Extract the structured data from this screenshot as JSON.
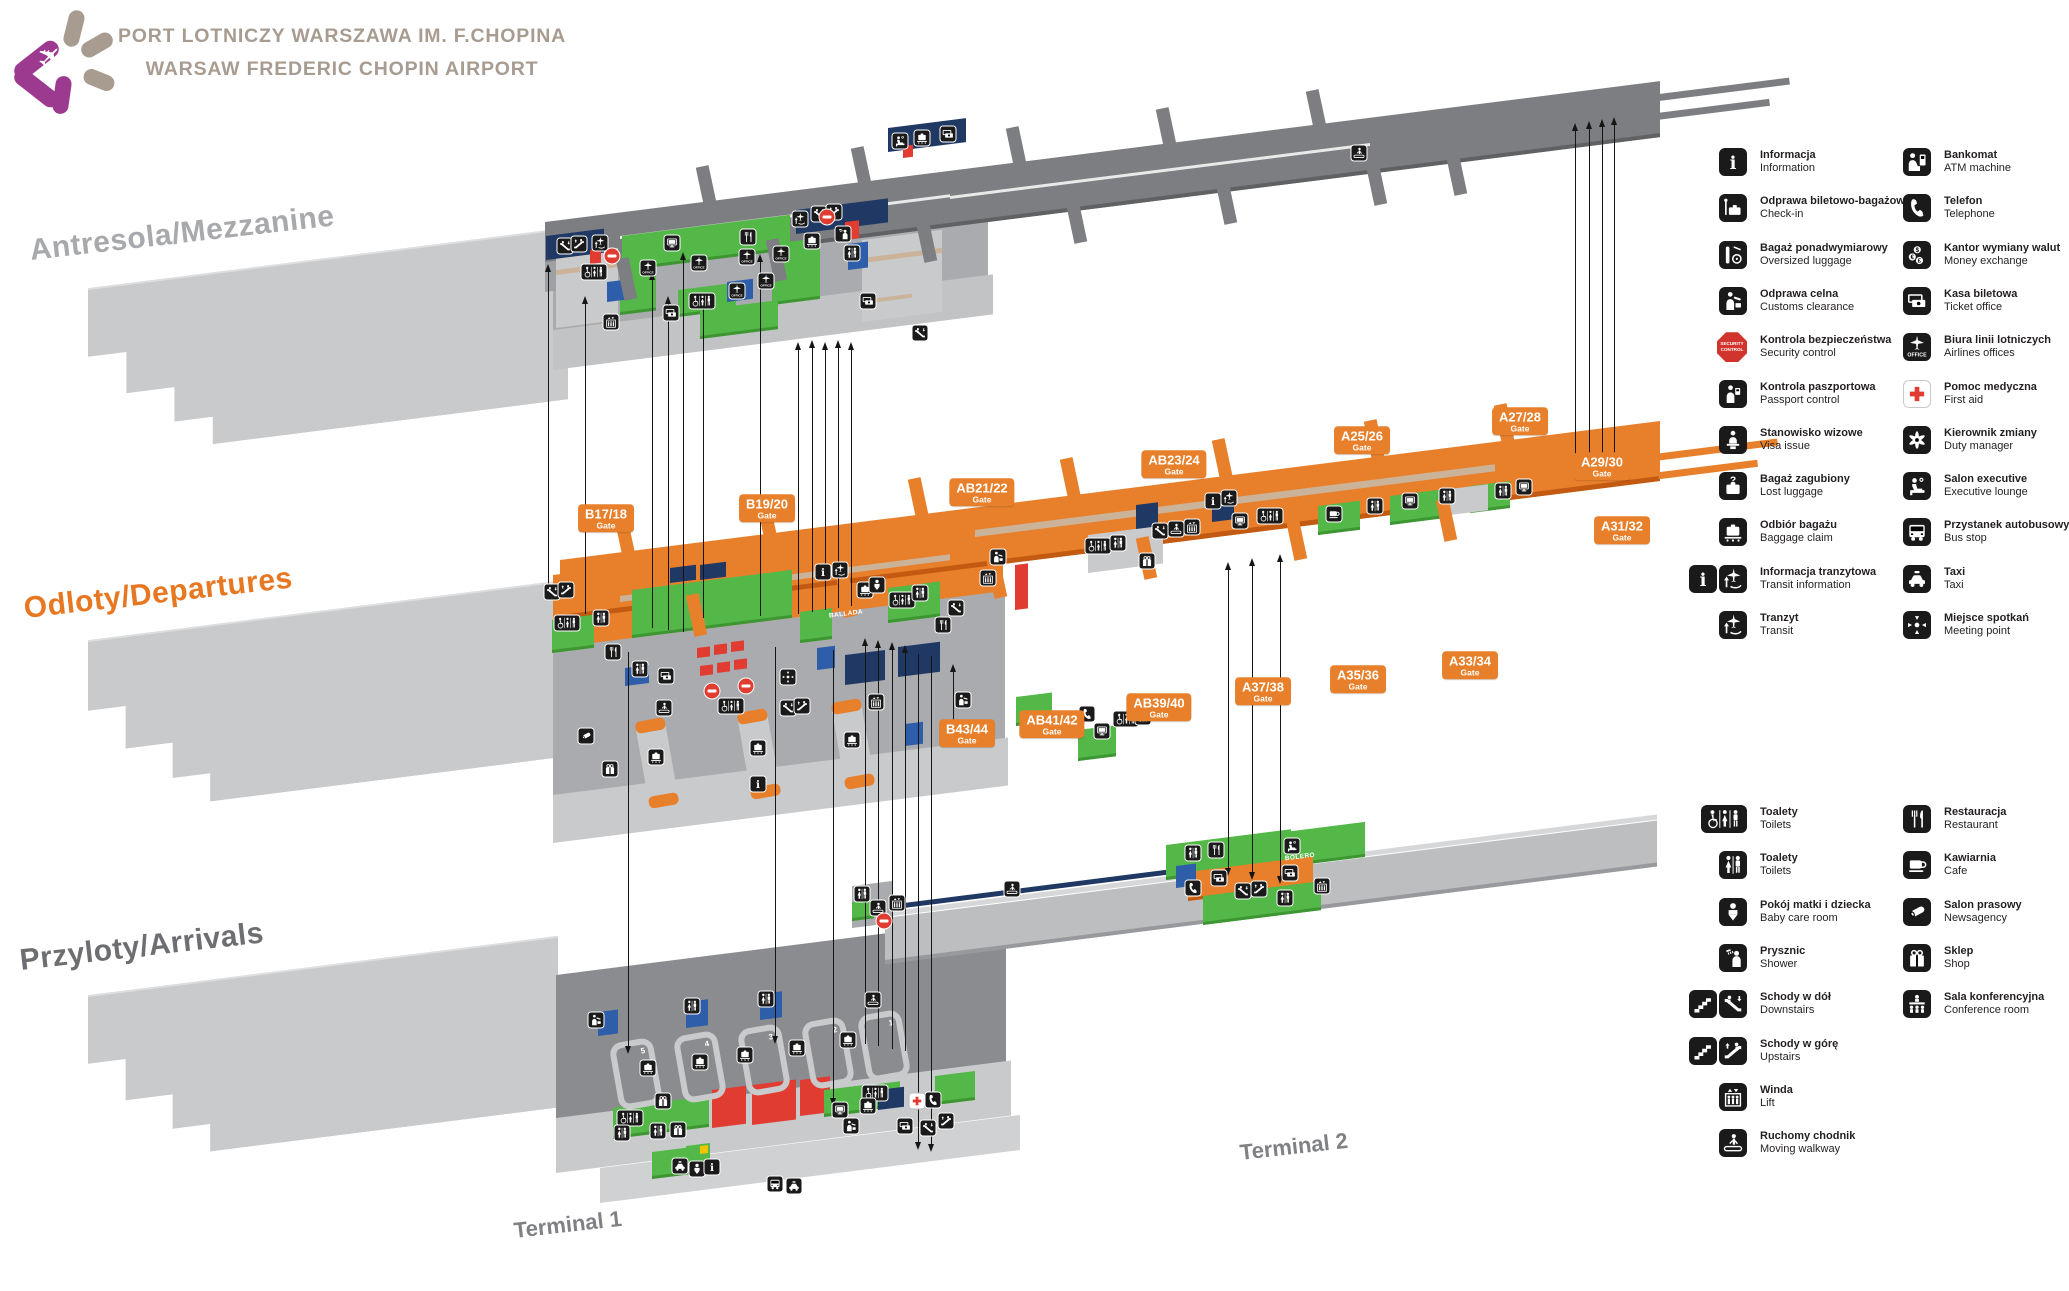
{
  "header": {
    "title_pl": "PORT LOTNICZY WARSZAWA IM. F.CHOPINA",
    "title_en": "WARSAW FREDERIC CHOPIN AIRPORT"
  },
  "levels": [
    {
      "id": "mezzanine",
      "label": "Antresola/Mezzanine"
    },
    {
      "id": "departures",
      "label": "Odloty/Departures"
    },
    {
      "id": "arrivals",
      "label": "Przyloty/Arrivals"
    }
  ],
  "terminals": [
    {
      "label": "Terminal 1"
    },
    {
      "label": "Terminal 2"
    }
  ],
  "area_labels": [
    {
      "text": "BALLADA",
      "x": 846,
      "y": 614
    },
    {
      "text": "BOLERO",
      "x": 1300,
      "y": 857
    }
  ],
  "carousels": [
    "5",
    "4",
    "3",
    "2",
    "1"
  ],
  "gates": {
    "sublabel": "Gate",
    "items": [
      {
        "label": "B17/18",
        "x": 606,
        "y": 518
      },
      {
        "label": "B19/20",
        "x": 767,
        "y": 508
      },
      {
        "label": "AB21/22",
        "x": 982,
        "y": 492
      },
      {
        "label": "AB23/24",
        "x": 1174,
        "y": 464
      },
      {
        "label": "A25/26",
        "x": 1362,
        "y": 440
      },
      {
        "label": "A27/28",
        "x": 1520,
        "y": 421
      },
      {
        "label": "A29/30",
        "x": 1602,
        "y": 466
      },
      {
        "label": "A31/32",
        "x": 1622,
        "y": 530
      },
      {
        "label": "A33/34",
        "x": 1470,
        "y": 665
      },
      {
        "label": "A35/36",
        "x": 1358,
        "y": 679
      },
      {
        "label": "A37/38",
        "x": 1263,
        "y": 691
      },
      {
        "label": "AB39/40",
        "x": 1159,
        "y": 707
      },
      {
        "label": "AB41/42",
        "x": 1052,
        "y": 724
      },
      {
        "label": "B43/44",
        "x": 967,
        "y": 733
      }
    ]
  },
  "legend": {
    "groups": [
      {
        "columns": [
          [
            {
              "pl": "Informacja",
              "en": "Information",
              "icons": [
                "info"
              ]
            },
            {
              "pl": "Odprawa biletowo-bagażowa",
              "en": "Check-in",
              "icons": [
                "checkin"
              ]
            },
            {
              "pl": "Bagaż ponadwymiarowy",
              "en": "Oversized luggage",
              "icons": [
                "oversized"
              ]
            },
            {
              "pl": "Odprawa celna",
              "en": "Customs clearance",
              "icons": [
                "customs"
              ]
            },
            {
              "pl": "Kontrola bezpieczeństwa",
              "en": "Security control",
              "icons": [
                "security"
              ],
              "icon_text": "SECURITY CONTROL"
            },
            {
              "pl": "Kontrola paszportowa",
              "en": "Passport control",
              "icons": [
                "passport"
              ]
            },
            {
              "pl": "Stanowisko wizowe",
              "en": "Visa issue",
              "icons": [
                "visa"
              ]
            },
            {
              "pl": "Bagaż zagubiony",
              "en": "Lost luggage",
              "icons": [
                "lost"
              ]
            },
            {
              "pl": "Odbiór bagażu",
              "en": "Baggage claim",
              "icons": [
                "claim"
              ]
            },
            {
              "pl": "Informacja tranzytowa",
              "en": "Transit information",
              "icons": [
                "info",
                "transit"
              ]
            },
            {
              "pl": "Tranzyt",
              "en": "Transit",
              "icons": [
                "transit"
              ]
            }
          ],
          [
            {
              "pl": "Bankomat",
              "en": "ATM machine",
              "icons": [
                "atm"
              ]
            },
            {
              "pl": "Telefon",
              "en": "Telephone",
              "icons": [
                "phone"
              ]
            },
            {
              "pl": "Kantor wymiany walut",
              "en": "Money exchange",
              "icons": [
                "exchange"
              ]
            },
            {
              "pl": "Kasa biletowa",
              "en": "Ticket office",
              "icons": [
                "ticket"
              ]
            },
            {
              "pl": "Biura linii lotniczych",
              "en": "Airlines offices",
              "icons": [
                "office"
              ]
            },
            {
              "pl": "Pomoc medyczna",
              "en": "First aid",
              "icons": [
                "firstaid"
              ]
            },
            {
              "pl": "Kierownik zmiany",
              "en": "Duty manager",
              "icons": [
                "duty"
              ]
            },
            {
              "pl": "Salon executive",
              "en": "Executive lounge",
              "icons": [
                "lounge"
              ]
            },
            {
              "pl": "Przystanek autobusowy",
              "en": "Bus stop",
              "icons": [
                "bus"
              ]
            },
            {
              "pl": "Taxi",
              "en": "Taxi",
              "icons": [
                "taxi"
              ]
            },
            {
              "pl": "Miejsce spotkań",
              "en": "Meeting point",
              "icons": [
                "meeting"
              ]
            }
          ]
        ]
      },
      {
        "columns": [
          [
            {
              "pl": "Toalety",
              "en": "Toilets",
              "icons": [
                "toilets-acc"
              ]
            },
            {
              "pl": "Toalety",
              "en": "Toilets",
              "icons": [
                "toilets"
              ]
            },
            {
              "pl": "Pokój matki i dziecka",
              "en": "Baby care room",
              "icons": [
                "baby"
              ]
            },
            {
              "pl": "Prysznic",
              "en": "Shower",
              "icons": [
                "shower"
              ]
            },
            {
              "pl": "Schody w dół",
              "en": "Downstairs",
              "icons": [
                "stairs",
                "esc-down"
              ]
            },
            {
              "pl": "Schody w górę",
              "en": "Upstairs",
              "icons": [
                "stairs",
                "esc-up"
              ]
            },
            {
              "pl": "Winda",
              "en": "Lift",
              "icons": [
                "lift"
              ]
            },
            {
              "pl": "Ruchomy chodnik",
              "en": "Moving walkway",
              "icons": [
                "walkway"
              ]
            }
          ],
          [
            {
              "pl": "Restauracja",
              "en": "Restaurant",
              "icons": [
                "restaurant"
              ]
            },
            {
              "pl": "Kawiarnia",
              "en": "Cafe",
              "icons": [
                "cafe"
              ]
            },
            {
              "pl": "Salon prasowy",
              "en": "Newsagency",
              "icons": [
                "news"
              ]
            },
            {
              "pl": "Sklep",
              "en": "Shop",
              "icons": [
                "shop"
              ]
            },
            {
              "pl": "Sala konferencyjna",
              "en": "Conference room",
              "icons": [
                "conference"
              ]
            }
          ]
        ]
      }
    ]
  },
  "map_icons": [
    [
      565,
      246,
      "esc-down"
    ],
    [
      579,
      244,
      "esc-up"
    ],
    [
      600,
      243,
      "transit"
    ],
    [
      612,
      256,
      "stop"
    ],
    [
      594,
      272,
      "toilets-acc"
    ],
    [
      672,
      243,
      "screen"
    ],
    [
      748,
      237,
      "restaurant"
    ],
    [
      648,
      268,
      "office"
    ],
    [
      699,
      263,
      "office"
    ],
    [
      747,
      257,
      "office"
    ],
    [
      781,
      254,
      "office"
    ],
    [
      737,
      291,
      "office"
    ],
    [
      766,
      281,
      "office"
    ],
    [
      702,
      301,
      "toilets-acc"
    ],
    [
      671,
      313,
      "ticket"
    ],
    [
      611,
      322,
      "lift"
    ],
    [
      800,
      219,
      "transit"
    ],
    [
      819,
      214,
      "esc-down"
    ],
    [
      834,
      212,
      "esc-up"
    ],
    [
      827,
      217,
      "stop"
    ],
    [
      812,
      241,
      "claim"
    ],
    [
      843,
      234,
      "shower"
    ],
    [
      852,
      253,
      "toilets"
    ],
    [
      868,
      301,
      "ticket"
    ],
    [
      920,
      333,
      "esc-down"
    ],
    [
      900,
      141,
      "lounge"
    ],
    [
      922,
      138,
      "claim"
    ],
    [
      948,
      134,
      "ticket"
    ],
    [
      1359,
      153,
      "walkway"
    ],
    [
      552,
      592,
      "esc-down"
    ],
    [
      566,
      590,
      "esc-up"
    ],
    [
      567,
      623,
      "toilets-acc"
    ],
    [
      601,
      618,
      "toilets"
    ],
    [
      613,
      652,
      "restaurant"
    ],
    [
      640,
      669,
      "toilets"
    ],
    [
      666,
      676,
      "ticket"
    ],
    [
      712,
      691,
      "stop"
    ],
    [
      746,
      686,
      "stop"
    ],
    [
      731,
      706,
      "toilets-acc"
    ],
    [
      788,
      708,
      "esc-down"
    ],
    [
      802,
      706,
      "esc-up"
    ],
    [
      823,
      572,
      "info"
    ],
    [
      840,
      570,
      "transit"
    ],
    [
      865,
      590,
      "claim"
    ],
    [
      877,
      585,
      "baby"
    ],
    [
      902,
      600,
      "toilets-acc"
    ],
    [
      920,
      593,
      "toilets"
    ],
    [
      943,
      625,
      "restaurant"
    ],
    [
      956,
      608,
      "esc-down"
    ],
    [
      656,
      757,
      "claim"
    ],
    [
      758,
      748,
      "claim"
    ],
    [
      852,
      740,
      "claim"
    ],
    [
      758,
      784,
      "info"
    ],
    [
      586,
      736,
      "news"
    ],
    [
      610,
      769,
      "shop"
    ],
    [
      664,
      708,
      "walkway"
    ],
    [
      876,
      702,
      "lift"
    ],
    [
      788,
      677,
      "meeting"
    ],
    [
      963,
      700,
      "customs"
    ],
    [
      1048,
      727,
      "lounge"
    ],
    [
      1087,
      714,
      "phone"
    ],
    [
      1102,
      731,
      "screen"
    ],
    [
      1126,
      719,
      "toilets-acc"
    ],
    [
      1143,
      717,
      "toilets"
    ],
    [
      998,
      557,
      "customs"
    ],
    [
      988,
      578,
      "lift"
    ],
    [
      1098,
      546,
      "toilets-acc"
    ],
    [
      1118,
      543,
      "toilets"
    ],
    [
      1147,
      561,
      "shop"
    ],
    [
      1160,
      531,
      "esc-down"
    ],
    [
      1176,
      529,
      "walkway"
    ],
    [
      1192,
      527,
      "lift"
    ],
    [
      1213,
      501,
      "info"
    ],
    [
      1229,
      498,
      "transit"
    ],
    [
      1240,
      521,
      "screen"
    ],
    [
      1270,
      516,
      "toilets-acc"
    ],
    [
      1334,
      514,
      "cafe"
    ],
    [
      1375,
      506,
      "toilets"
    ],
    [
      1410,
      501,
      "screen"
    ],
    [
      1447,
      496,
      "toilets"
    ],
    [
      1503,
      491,
      "toilets"
    ],
    [
      1524,
      487,
      "screen"
    ],
    [
      596,
      1020,
      "customs"
    ],
    [
      692,
      1006,
      "toilets"
    ],
    [
      766,
      999,
      "toilets"
    ],
    [
      873,
      1000,
      "walkway"
    ],
    [
      648,
      1068,
      "claim"
    ],
    [
      700,
      1062,
      "claim"
    ],
    [
      745,
      1055,
      "claim"
    ],
    [
      797,
      1048,
      "claim"
    ],
    [
      848,
      1040,
      "claim"
    ],
    [
      663,
      1101,
      "shop"
    ],
    [
      630,
      1118,
      "toilets-acc"
    ],
    [
      622,
      1133,
      "toilets"
    ],
    [
      658,
      1131,
      "toilets"
    ],
    [
      678,
      1130,
      "shop"
    ],
    [
      840,
      1110,
      "screen"
    ],
    [
      851,
      1126,
      "customs"
    ],
    [
      875,
      1093,
      "toilets-acc"
    ],
    [
      868,
      1106,
      "claim"
    ],
    [
      917,
      1101,
      "firstaid"
    ],
    [
      933,
      1100,
      "phone"
    ],
    [
      905,
      1126,
      "ticket"
    ],
    [
      928,
      1128,
      "esc-down"
    ],
    [
      946,
      1121,
      "esc-up"
    ],
    [
      680,
      1166,
      "taxi"
    ],
    [
      697,
      1169,
      "baby"
    ],
    [
      712,
      1167,
      "info"
    ],
    [
      775,
      1184,
      "bus"
    ],
    [
      794,
      1186,
      "taxi"
    ],
    [
      1193,
      853,
      "toilets"
    ],
    [
      1216,
      850,
      "restaurant"
    ],
    [
      1292,
      846,
      "lounge"
    ],
    [
      1193,
      888,
      "phone"
    ],
    [
      1243,
      891,
      "esc-down"
    ],
    [
      1259,
      889,
      "esc-up"
    ],
    [
      1285,
      898,
      "toilets"
    ],
    [
      1219,
      878,
      "ticket"
    ],
    [
      1290,
      873,
      "ticket"
    ],
    [
      1322,
      886,
      "lift"
    ],
    [
      1012,
      889,
      "walkway"
    ],
    [
      897,
      903,
      "lift"
    ],
    [
      878,
      908,
      "walkway"
    ],
    [
      862,
      894,
      "toilets"
    ],
    [
      884,
      921,
      "stop"
    ]
  ],
  "arrows": [
    [
      548,
      268,
      598,
      "up"
    ],
    [
      585,
      300,
      614,
      "up"
    ],
    [
      652,
      276,
      628,
      "up"
    ],
    [
      668,
      300,
      630,
      "up"
    ],
    [
      683,
      256,
      632,
      "up"
    ],
    [
      703,
      300,
      618,
      "up"
    ],
    [
      760,
      258,
      616,
      "up"
    ],
    [
      798,
      346,
      614,
      "up"
    ],
    [
      812,
      344,
      612,
      "up"
    ],
    [
      825,
      346,
      610,
      "up"
    ],
    [
      838,
      344,
      608,
      "up"
    ],
    [
      851,
      346,
      606,
      "up"
    ],
    [
      865,
      642,
      1044,
      "up"
    ],
    [
      878,
      644,
      1046,
      "up"
    ],
    [
      892,
      646,
      1049,
      "up"
    ],
    [
      905,
      649,
      1051,
      "up"
    ],
    [
      953,
      668,
      745,
      "up"
    ],
    [
      628,
      652,
      1050,
      "down"
    ],
    [
      775,
      647,
      1040,
      "down"
    ],
    [
      833,
      650,
      1102,
      "down"
    ],
    [
      918,
      654,
      1146,
      "down"
    ],
    [
      931,
      656,
      1148,
      "down"
    ],
    [
      1228,
      566,
      872,
      "both"
    ],
    [
      1252,
      562,
      876,
      "both"
    ],
    [
      1280,
      558,
      880,
      "both"
    ],
    [
      1575,
      127,
      474,
      "up"
    ],
    [
      1589,
      125,
      476,
      "up"
    ],
    [
      1602,
      123,
      478,
      "up"
    ],
    [
      1614,
      121,
      480,
      "up"
    ]
  ],
  "colors": {
    "orange": "#E8802B",
    "green": "#53B848",
    "navy": "#1F3864",
    "blue": "#2E5EAA",
    "red": "#E03C31",
    "plate": "#C9CACC",
    "pier_gray": "#7C7E81",
    "hall_gray": "#A9ABAE",
    "arr_hall": "#8A8C8F",
    "tan": "#CBB39A",
    "brand_magenta": "#9C3A90",
    "brand_taupe": "#A89C91",
    "label_gray": "#A7A9AC",
    "label_dark": "#6D6E71"
  }
}
